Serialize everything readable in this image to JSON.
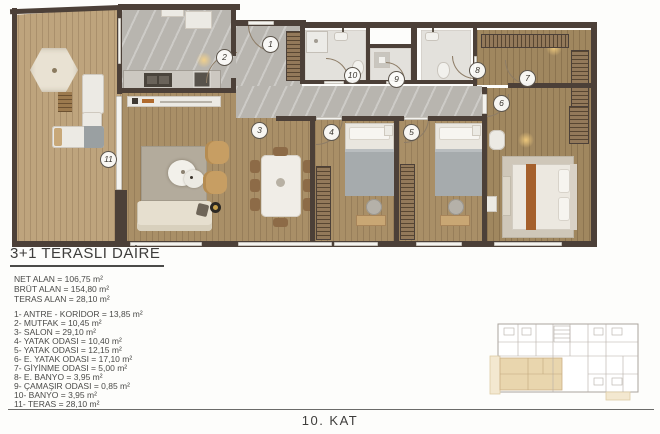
{
  "title": "3+1 TERASLI DAİRE",
  "areas": {
    "net": "NET ALAN = 106,75 m²",
    "brut": "BRÜT ALAN = 154,80 m²",
    "teras": "TERAS ALAN = 28,10 m²"
  },
  "rooms": [
    "1- ANTRE - KORİDOR = 13,85 m²",
    "2- MUTFAK = 10,45 m²",
    "3- SALON = 29,10 m²",
    "4- YATAK ODASI = 10,40 m²",
    "5- YATAK ODASI = 12,15 m²",
    "6- E. YATAK ODASI = 17,10 m²",
    "7- GİYİNME ODASI = 5,00 m²",
    "8- E. BANYO = 3,95 m²",
    "9- ÇAMAŞIR ODASI = 0,85 m²",
    "10- BANYO = 3,95 m²",
    "11- TERAS = 28,10 m²"
  ],
  "floor_label": "10. KAT",
  "plan": {
    "markers": [
      "1",
      "2",
      "3",
      "4",
      "5",
      "6",
      "7",
      "8",
      "9",
      "10",
      "11"
    ]
  },
  "colors": {
    "wall": "#4c4038",
    "interior_wood": "#a98f67",
    "terrace_wood": "#bea47d",
    "marble": "#b8b5af",
    "bath_floor": "#e3e1dc",
    "keyplan_highlight": "#e9d6ae",
    "text": "#4a4a48"
  }
}
